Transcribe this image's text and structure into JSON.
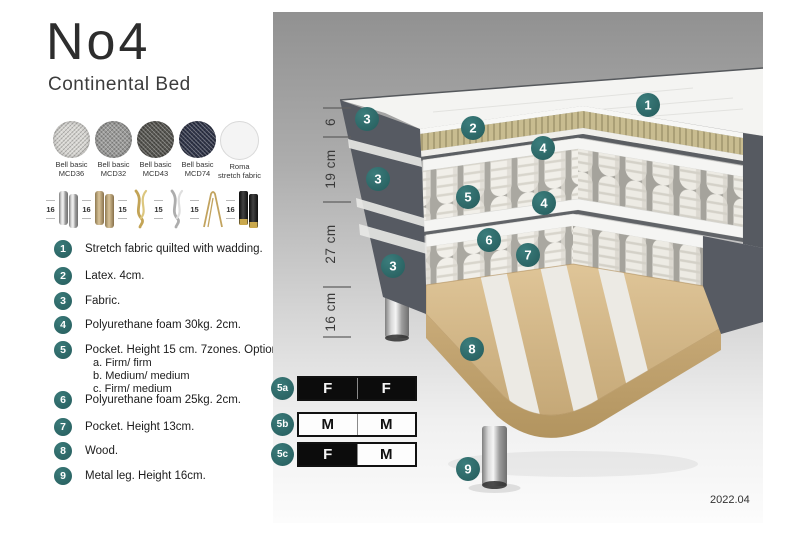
{
  "page": {
    "title": "No4",
    "subtitle": "Continental Bed"
  },
  "colors": {
    "accent_teal": "#2E6F6F",
    "dark_fabric": "#565A62",
    "latex": "#C6BA8E",
    "wood": "#D8BD8F",
    "firm_black": "#0C0C0C"
  },
  "fabrics": [
    {
      "line1": "Bell basic",
      "line2": "MCD36",
      "color": "#D8D7D3"
    },
    {
      "line1": "Bell basic",
      "line2": "MCD32",
      "color": "#9A9A98"
    },
    {
      "line1": "Bell basic",
      "line2": "MCD43",
      "color": "#55544F"
    },
    {
      "line1": "Bell basic",
      "line2": "MCD74",
      "color": "#2F3448"
    },
    {
      "line1": "Roma",
      "line2": "stretch fabric",
      "color": "#F4F4F4"
    }
  ],
  "legs": [
    {
      "height": "16",
      "type": "cylinder-chrome"
    },
    {
      "height": "16",
      "type": "cylinder-wood"
    },
    {
      "height": "15",
      "type": "twisted-gold"
    },
    {
      "height": "15",
      "type": "twisted-silver"
    },
    {
      "height": "15",
      "type": "hairpin-gold"
    },
    {
      "height": "16",
      "type": "cylinder-black-gold"
    }
  ],
  "spec_list": [
    {
      "num": "1",
      "text": "Stretch fabric quilted with wadding."
    },
    {
      "num": "2",
      "text": "Latex. 4cm."
    },
    {
      "num": "3",
      "text": "Fabric."
    },
    {
      "num": "4",
      "text": "Polyurethane foam 30kg. 2cm."
    },
    {
      "num": "5",
      "text": "Pocket. Height 15 cm. 7zones. Option:",
      "options": [
        "a. Firm/ firm",
        "b. Medium/ medium",
        "c. Firm/ medium"
      ]
    },
    {
      "num": "6",
      "text": "Polyurethane foam 25kg. 2cm."
    },
    {
      "num": "7",
      "text": "Pocket. Height 13cm."
    },
    {
      "num": "8",
      "text": "Wood."
    },
    {
      "num": "9",
      "text": "Metal leg. Height 16cm."
    }
  ],
  "diagram": {
    "dimensions": [
      {
        "label": "6"
      },
      {
        "label": "19 cm"
      },
      {
        "label": "27 cm"
      },
      {
        "label": "16 cm"
      }
    ],
    "callouts": [
      {
        "n": "1"
      },
      {
        "n": "2"
      },
      {
        "n": "3"
      },
      {
        "n": "3"
      },
      {
        "n": "3"
      },
      {
        "n": "4"
      },
      {
        "n": "4"
      },
      {
        "n": "5"
      },
      {
        "n": "6"
      },
      {
        "n": "7"
      },
      {
        "n": "8"
      },
      {
        "n": "9"
      }
    ],
    "firmness": [
      {
        "label": "5a",
        "cells": [
          {
            "value": "F",
            "style": "dark"
          },
          {
            "value": "F",
            "style": "dark"
          }
        ]
      },
      {
        "label": "5b",
        "cells": [
          {
            "value": "M",
            "style": "light"
          },
          {
            "value": "M",
            "style": "light"
          }
        ]
      },
      {
        "label": "5c",
        "cells": [
          {
            "value": "F",
            "style": "dark"
          },
          {
            "value": "M",
            "style": "light"
          }
        ]
      }
    ],
    "version": "2022.04"
  }
}
